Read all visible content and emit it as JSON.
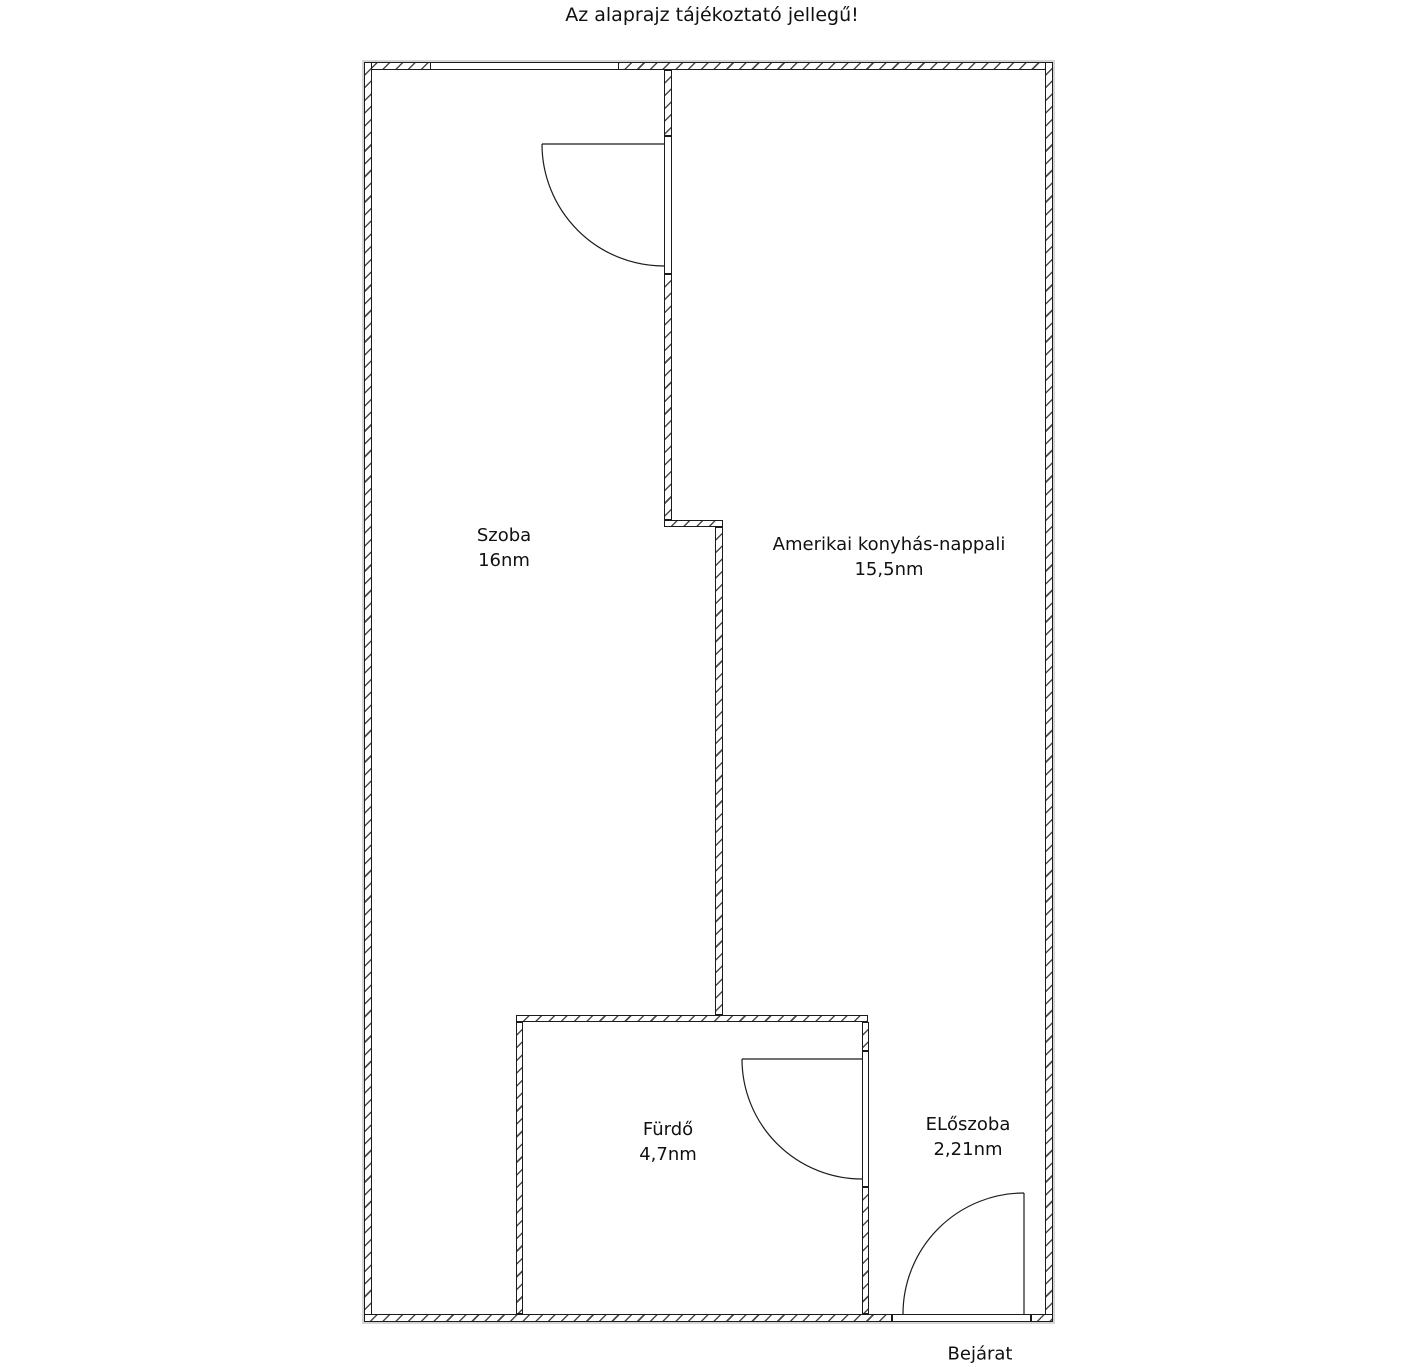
{
  "title": "Az alaprajz tájékoztató jellegű!",
  "rooms": {
    "szoba": {
      "name": "Szoba",
      "area": "16nm"
    },
    "nappali": {
      "name": "Amerikai konyhás-nappali",
      "area": "15,5nm"
    },
    "furdo": {
      "name": "Fürdő",
      "area": "4,7nm"
    },
    "eloszoba": {
      "name": "ELőszoba",
      "area": "2,21nm"
    }
  },
  "entrance": {
    "label": "Bejárat"
  },
  "colors": {
    "wall_line": "#1b1b1b",
    "hatch": "#4a4a4a",
    "outer_shadow": "#d5d5d5",
    "text": "#111111",
    "background": "#ffffff"
  }
}
